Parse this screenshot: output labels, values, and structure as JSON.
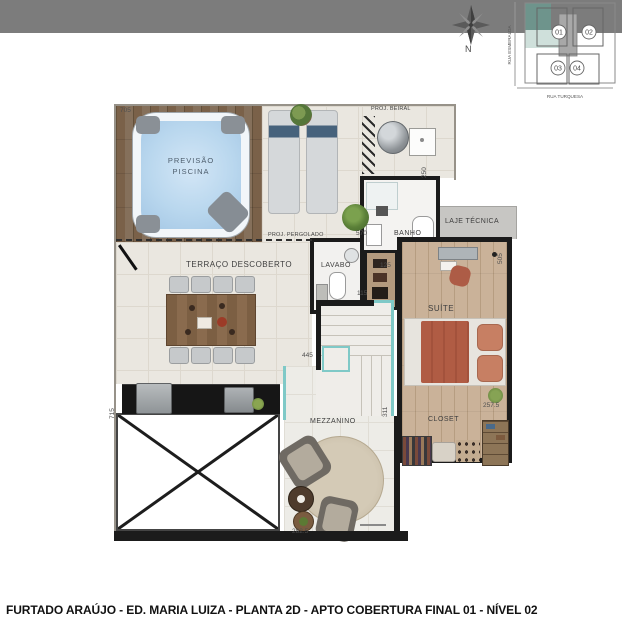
{
  "compass": {
    "north": "N"
  },
  "site_plan": {
    "street_left": "RUA ESMERALDA",
    "street_bottom": "RUA TURQUESA",
    "unit_01": "01",
    "unit_02": "02",
    "unit_03": "03",
    "unit_04": "04"
  },
  "rooms": {
    "pool_1": "PREVISÃO",
    "pool_2": "PISCINA",
    "terrace": "TERRAÇO DESCOBERTO",
    "banho": "BANHO",
    "lavabo": "LAVABO",
    "laje": "LAJE TÉCNICA",
    "suite": "SUÍTE",
    "closet": "CLOSET",
    "mezzanino": "MEZZANINO"
  },
  "annotations": {
    "proj_beiral": "PROJ. BEIRAL",
    "proj_pergolado": "PROJ. PERGOLADO"
  },
  "dimensions": {
    "d705": "705",
    "d570": "570",
    "d250": "250",
    "d125": "125",
    "d115": "115",
    "d445": "445",
    "d311": "311",
    "d505": "505",
    "d715": "715",
    "d282_5": "282.5",
    "d257_5": "257.5"
  },
  "footer": {
    "caption": "FURTADO ARAÚJO - ED. MARIA LUIZA - PLANTA 2D - APTO COBERTURA FINAL 01 - NÍVEL 02"
  },
  "colors": {
    "band": "#7c7c7c",
    "wall": "#1b1b1b",
    "pool_water": "#b9d7ee",
    "tile_floor": "#eae7e0",
    "suite_floor": "#c8b197",
    "laje_gray": "#c7c6c3",
    "glass_teal": "#7fc9c7",
    "bed_terracotta": "#b05c44",
    "site_teal_dark": "#6e948c",
    "site_teal_light": "#cfe0db"
  }
}
